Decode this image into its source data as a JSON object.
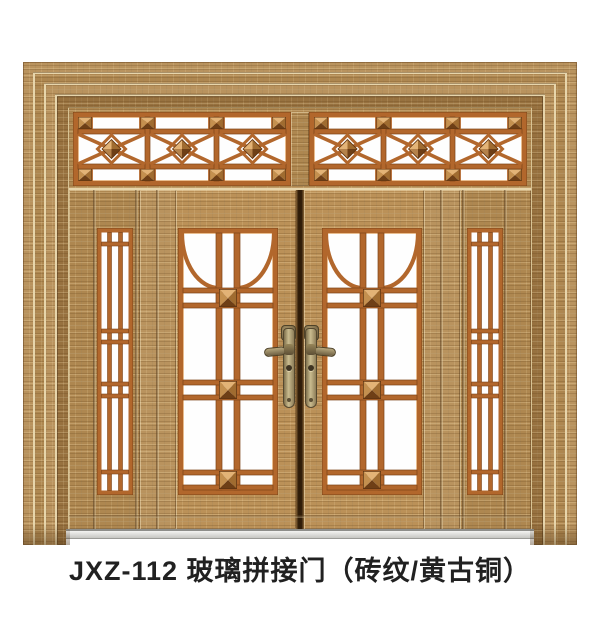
{
  "caption": "JXZ-112 玻璃拼接门（砖纹/黄古铜）",
  "product": {
    "model": "JXZ-112",
    "type": "玻璃拼接门",
    "finish": "砖纹/黄古铜"
  },
  "colors": {
    "background": "#ffffff",
    "wood_light": "#b9935e",
    "wood_mid": "#ae8750",
    "wood_dark": "#97713f",
    "copper_grille": "#b2672c",
    "glass": "#fefefe",
    "brass_handle": "#cabc8f",
    "threshold_gray": "#d9d9d6",
    "caption_text": "#212121"
  }
}
